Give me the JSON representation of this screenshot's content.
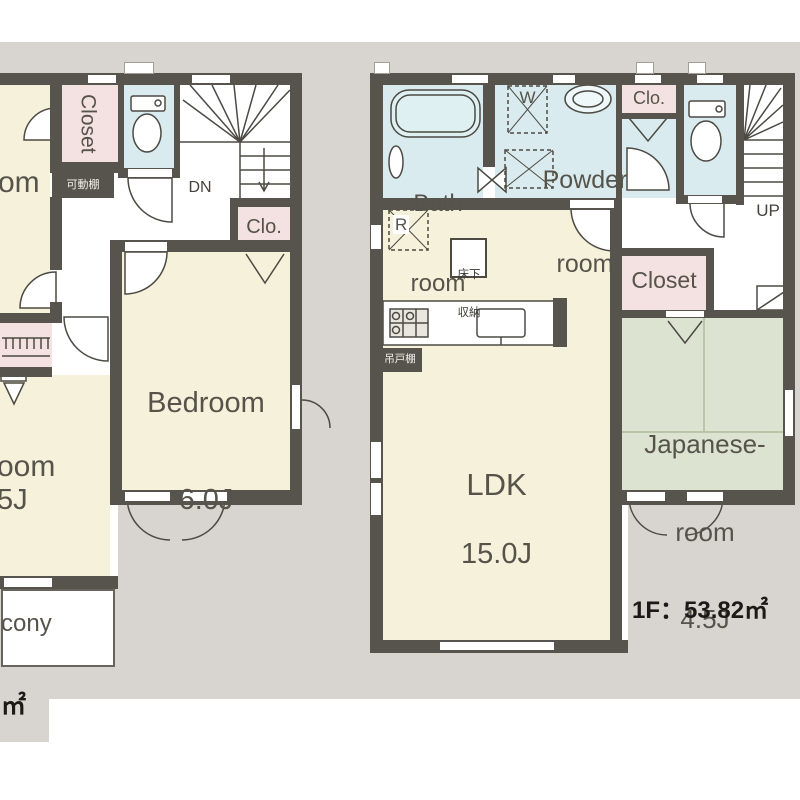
{
  "colors": {
    "background": "#d8d5d0",
    "wall": "#57544e",
    "room_yellow": "#f6f1da",
    "wet_blue": "#d9ebee",
    "closet_pink": "#f4e1e2",
    "tatami_green": "#dce4d1"
  },
  "floor2": {
    "room_top_left_fragment": "om",
    "closet_label": "Closet",
    "movable_shelf_label": "可動棚",
    "stairs_down_label": "DN",
    "small_closet_label": "Clo.",
    "bedroom_name": "Bedroom",
    "bedroom_size": "6.0J",
    "room_bottom_left_name_fragment": "oom",
    "room_bottom_left_size_fragment": "5J",
    "balcony_fragment": "cony",
    "floor_area_fragment": "㎡"
  },
  "floor1": {
    "bathroom_line1": "Bath",
    "bathroom_line2": "room",
    "washer_label": "W",
    "powder_line1": "Powder",
    "powder_line2": "room",
    "small_closet_label": "Clo.",
    "stairs_up_label": "UP",
    "closet_label": "Closet",
    "refrigerator_label": "R",
    "underfloor_line1": "床下",
    "underfloor_line2": "収納",
    "hanging_cabinet_label": "吊戸棚",
    "ldk_name": "LDK",
    "ldk_size": "15.0J",
    "japanese_room_line1": "Japanese-",
    "japanese_room_line2": "room",
    "japanese_room_size": "4.5J",
    "floor_area_text": "1F：53.82㎡"
  }
}
